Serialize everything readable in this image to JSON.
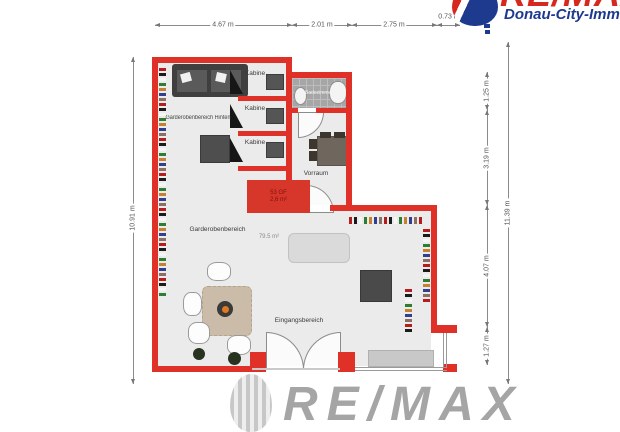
{
  "branding": {
    "logo_top": {
      "wordmark": "RE/MAX",
      "subtitle": "Donau-City-Immobilien"
    },
    "watermark": {
      "wordmark": "RE/MAX"
    }
  },
  "dimensions": {
    "top": [
      "4.67 m",
      "2.01 m",
      "2.75 m",
      "0.73 m"
    ],
    "left": [
      "10.91 m"
    ],
    "right_inner": [
      "1.25 m",
      "3.19 m",
      "4.07 m",
      "1.27 m"
    ],
    "right_outer": [
      "11.39 m"
    ]
  },
  "rooms": {
    "garderobe_hinten": {
      "label": "Garderobenbereich Hinten"
    },
    "kabine_1": {
      "label": "Kabine"
    },
    "kabine_2": {
      "label": "Kabine"
    },
    "kabine_3": {
      "label": "Kabine"
    },
    "badezimmer": {
      "label": "Badezimmer"
    },
    "vorraum": {
      "label": "Vorraum"
    },
    "garderobe": {
      "label": "Garderobenbereich",
      "area": "79.5 m²"
    },
    "eingang": {
      "label": "Eingangsbereich"
    },
    "stiege": {
      "line1": "53 GF",
      "line2": "2,6 m²"
    }
  },
  "palette": {
    "wall_red": "#df3127",
    "floor_gray": "#ebebeb",
    "tile_gray": "#a6a6a6",
    "logo_blue": "#1d3a8e",
    "logo_red": "#d6281e",
    "watermark_gray": "#a5a5a5",
    "rack_colors": [
      "#b71c1c",
      "#1b1b1b",
      "#f5f5f5",
      "#2e7d32",
      "#c87f2f",
      "#303f8f",
      "#8d6e63"
    ]
  }
}
